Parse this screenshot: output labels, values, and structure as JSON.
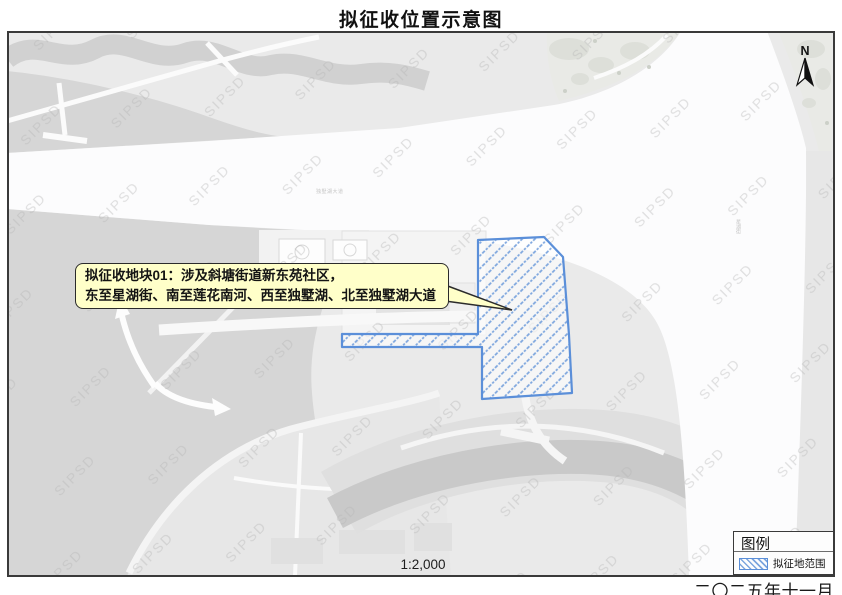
{
  "title": "拟征收位置示意图",
  "map": {
    "watermark": "SIPSD",
    "north_label": "N",
    "scale_label": "1:2,000",
    "callout": {
      "line1": "拟征收地块01：涉及斜塘街道新东苑社区，",
      "line2": "东至星湖街、南至莲花南河、西至独墅湖、北至独墅湖大道"
    },
    "road_labels": {
      "avenue": "独墅湖大道",
      "street": "星湖街"
    },
    "colors": {
      "parcel_border": "#5b8fd9",
      "parcel_hatch": "#7da6de",
      "callout_bg": "#ffffc9",
      "water_gray": "#d6d6d6",
      "road_white": "#fcfcfd"
    }
  },
  "legend": {
    "title": "图例",
    "items": [
      {
        "label": "拟征地范围",
        "swatch": "blue-diagonal-hatch"
      }
    ]
  },
  "footer": {
    "date": "二〇二五年十一月"
  }
}
